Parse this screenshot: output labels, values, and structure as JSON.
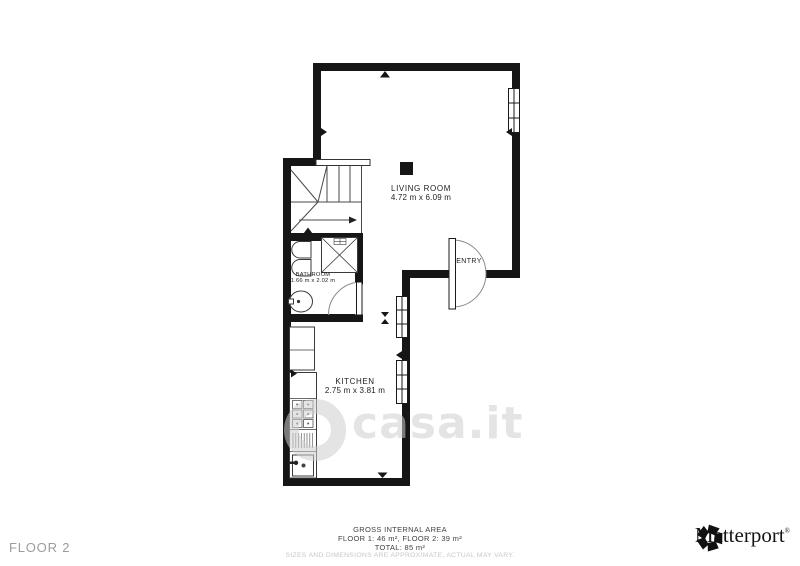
{
  "watermark": {
    "text": "casa.it"
  },
  "floorplan": {
    "rooms": [
      {
        "name": "LIVING ROOM",
        "dims": "4.72 m x 6.09 m"
      },
      {
        "name": "ENTRY",
        "dims": ""
      },
      {
        "name": "BATHROOM",
        "dims": "1.66 m x 2.02 m"
      },
      {
        "name": "KITCHEN",
        "dims": "2.75 m x 3.81 m"
      }
    ]
  },
  "footer": {
    "floor_label": "FLOOR 2",
    "gross_area_title": "GROSS INTERNAL AREA",
    "floors_line": "FLOOR 1: 46 m², FLOOR 2: 39 m²",
    "total_line": "TOTAL: 85 m²",
    "disclaimer": "SIZES AND DIMENSIONS ARE APPROXIMATE, ACTUAL MAY VARY.",
    "brand_name": "Matterport",
    "brand_mark": "®"
  }
}
